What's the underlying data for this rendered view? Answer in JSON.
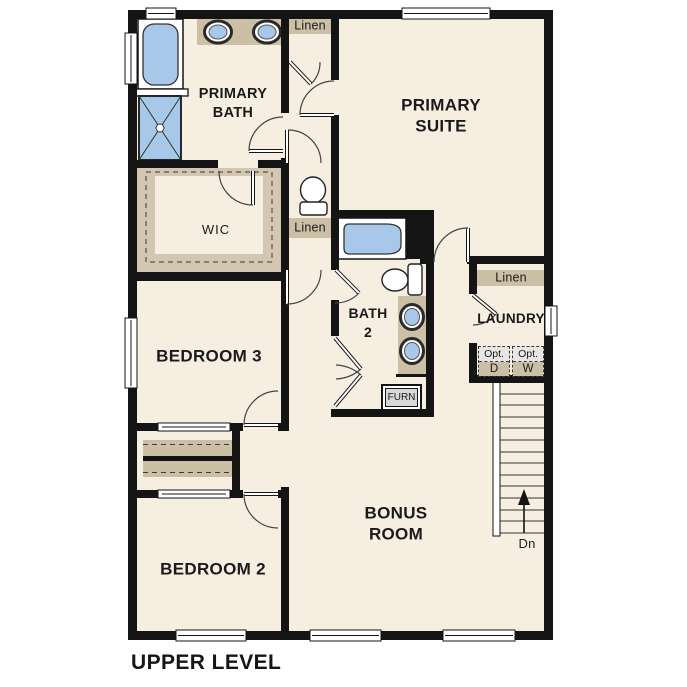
{
  "palette": {
    "floor": "#f6eee1",
    "wall": "#141414",
    "fixture_blue": "#a7c8e8",
    "cabinet_tan": "#cbbfa6",
    "wic_tan": "#d3c7b1",
    "furn_gray": "#d8d8d8",
    "opt_gray": "#e6e6e4",
    "ink": "#1a1a1a"
  },
  "plan": {
    "title": "UPPER LEVEL",
    "rooms": {
      "primary_bath": "PRIMARY\nBATH",
      "primary_suite": "PRIMARY\nSUITE",
      "wic": "WIC",
      "bedroom3": "BEDROOM 3",
      "bath2": "BATH\n2",
      "laundry": "LAUNDRY",
      "bonus_room": "BONUS\nROOM",
      "bedroom2": "BEDROOM 2"
    },
    "closets": {
      "linen_top": "Linen",
      "linen_hall": "Linen",
      "linen_laundry": "Linen"
    },
    "equipment": {
      "furnace": "FURN",
      "opt_dryer": {
        "line1": "Opt.",
        "line2": "D"
      },
      "opt_washer": {
        "line1": "Opt.",
        "line2": "W"
      }
    },
    "stairs": {
      "direction_label": "Dn"
    }
  }
}
